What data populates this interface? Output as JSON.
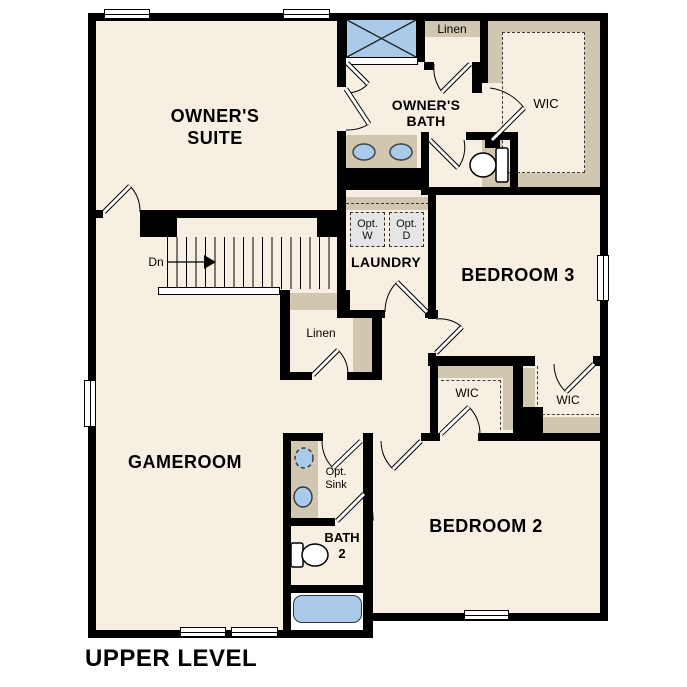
{
  "title": "UPPER LEVEL",
  "rooms": {
    "owners_suite": {
      "l1": "OWNER'S",
      "l2": "SUITE"
    },
    "owners_bath": {
      "l1": "OWNER'S",
      "l2": "BATH"
    },
    "gameroom": {
      "label": "GAMEROOM"
    },
    "laundry": {
      "label": "LAUNDRY"
    },
    "bedroom3": {
      "label": "BEDROOM 3"
    },
    "bedroom2": {
      "label": "BEDROOM 2"
    },
    "bath2": {
      "l1": "BATH",
      "l2": "2"
    }
  },
  "closets": {
    "linen_top": "Linen",
    "linen_hall": "Linen",
    "wic_owners": "WIC",
    "wic_bedroom2": "WIC",
    "wic_bedroom3": "WIC"
  },
  "annotations": {
    "opt_washer": {
      "l1": "Opt.",
      "l2": "W"
    },
    "opt_dryer": {
      "l1": "Opt.",
      "l2": "D"
    },
    "opt_sink": {
      "l1": "Opt.",
      "l2": "Sink"
    },
    "stairs_down": "Dn"
  },
  "fixtures": [
    "shower",
    "bathtub",
    "toilet-owners-bath",
    "toilet-bath2",
    "double-vanity-sinks",
    "optional-sink",
    "sink",
    "stairs-down"
  ],
  "colors": {
    "floor": "#f7f0e2",
    "wall": "#000000",
    "shelf_tan": "#d1c6af",
    "fixture_blue": "#a9cbe9",
    "appliance_gray": "#e5e5e5",
    "background": "#ffffff"
  }
}
